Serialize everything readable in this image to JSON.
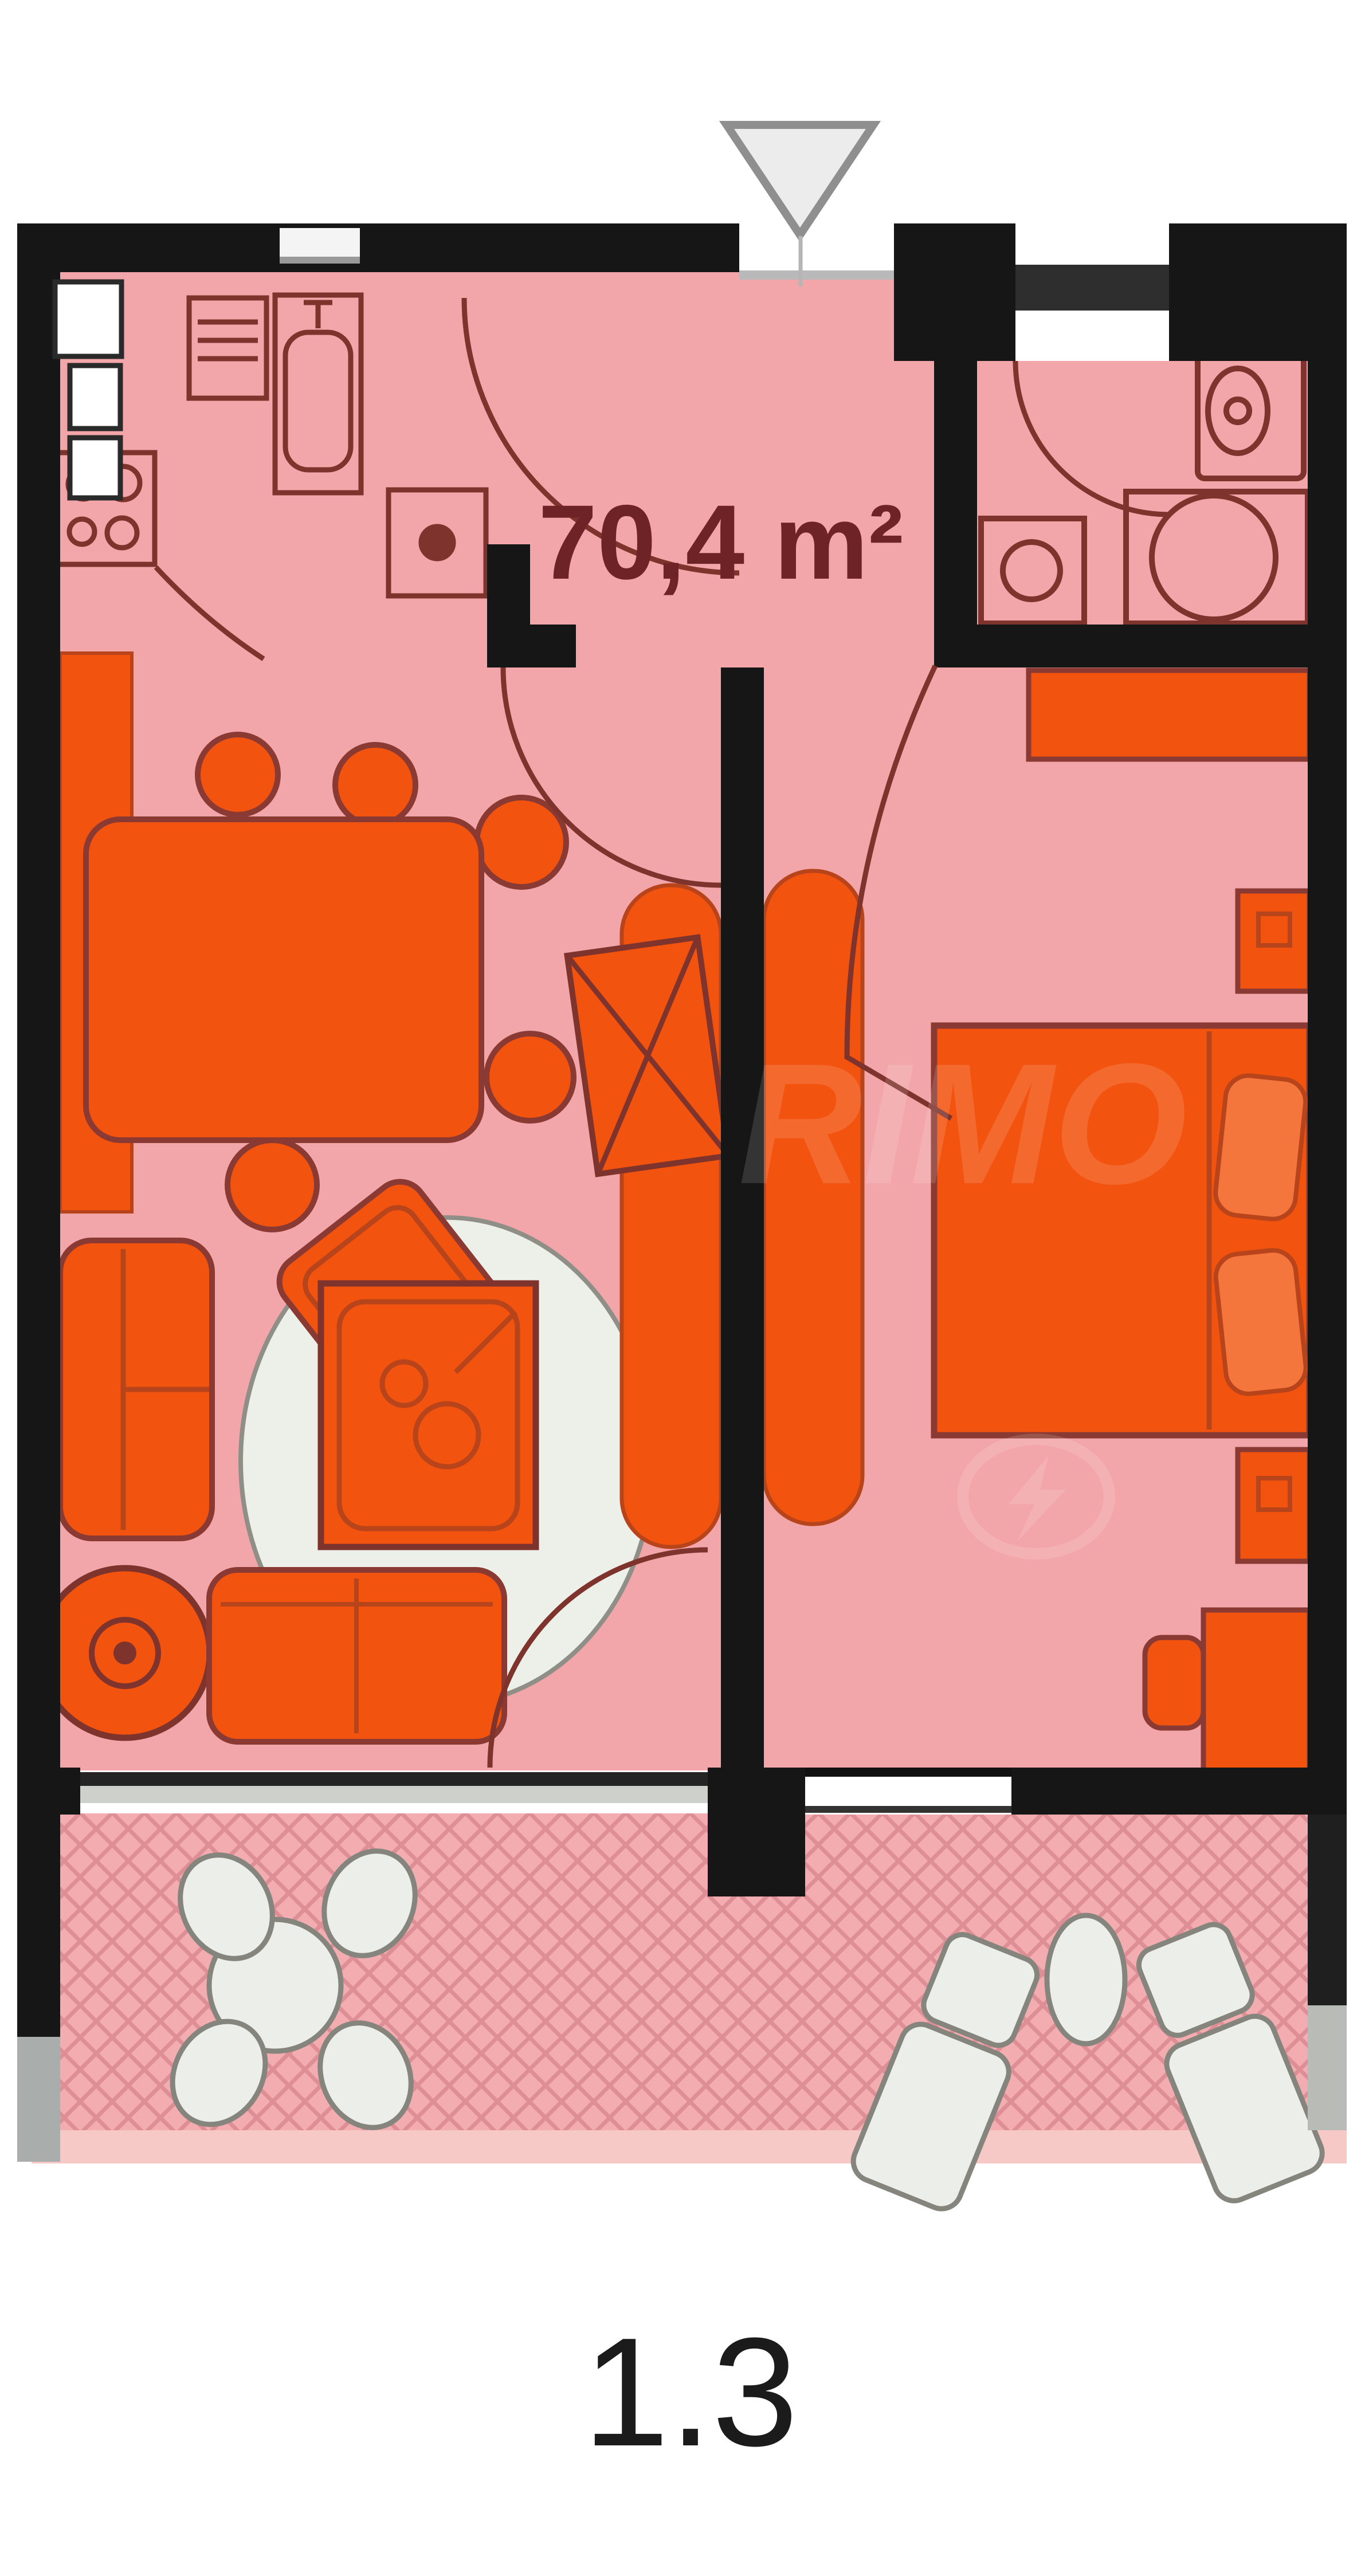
{
  "plan": {
    "area_label": "70,4 m²",
    "unit_number": "1.3",
    "entrance_marker": "triangle-down-icon",
    "watermark_text": "RIMO",
    "watermark_icon": "lightning-bolt-icon"
  },
  "colors": {
    "wall": "#161616",
    "room": "#f3a6a9",
    "room_line": "#7e332c",
    "furniture": "#f2530e",
    "furniture_line": "#8a3a33",
    "furniture_inner": "#b8441c",
    "pillow": "#f4763d",
    "rug": "#edf0e8",
    "rug_line": "#8f8f88",
    "balcony": "#f3adb1",
    "hatch": "#de8f96",
    "balcony_item": "#eceeea",
    "balcony_item_line": "#85857e",
    "glass": "#ced1cb",
    "window_white": "#ffffff",
    "label": "#6e2426",
    "number": "#1b1b1b",
    "arrow_fill": "#ececec",
    "arrow_line": "#8f8f8f",
    "door_leaf": "#2e2e2e",
    "balcony_strip": "#f6c8c6"
  },
  "symbols": {
    "kitchen": [
      "fridge-icon",
      "oven-icon",
      "sink-icon",
      "hob-4-burners-icon",
      "small-table-icon"
    ],
    "dining": [
      "dining-table-icon",
      "dining-chair-icon",
      "bench-icon"
    ],
    "living": [
      "sofa-icon",
      "armchair-icon",
      "coffee-table-icon",
      "swivel-chair-icon",
      "rug-icon",
      "tv-stand-icon",
      "sideboard-icon"
    ],
    "bedroom": [
      "double-bed-icon",
      "pillow-icon",
      "wardrobe-icon",
      "dresser-icon",
      "nightstand-icon",
      "desk-icon",
      "desk-chair-icon"
    ],
    "bathroom": [
      "washbasin-icon",
      "toilet-icon",
      "shower-icon",
      "washing-machine-icon"
    ],
    "balcony": [
      "round-table-icon",
      "garden-chair-icon",
      "sun-lounger-icon",
      "side-table-icon"
    ],
    "doors": [
      "door-swing-arc",
      "entrance-arrow"
    ]
  }
}
